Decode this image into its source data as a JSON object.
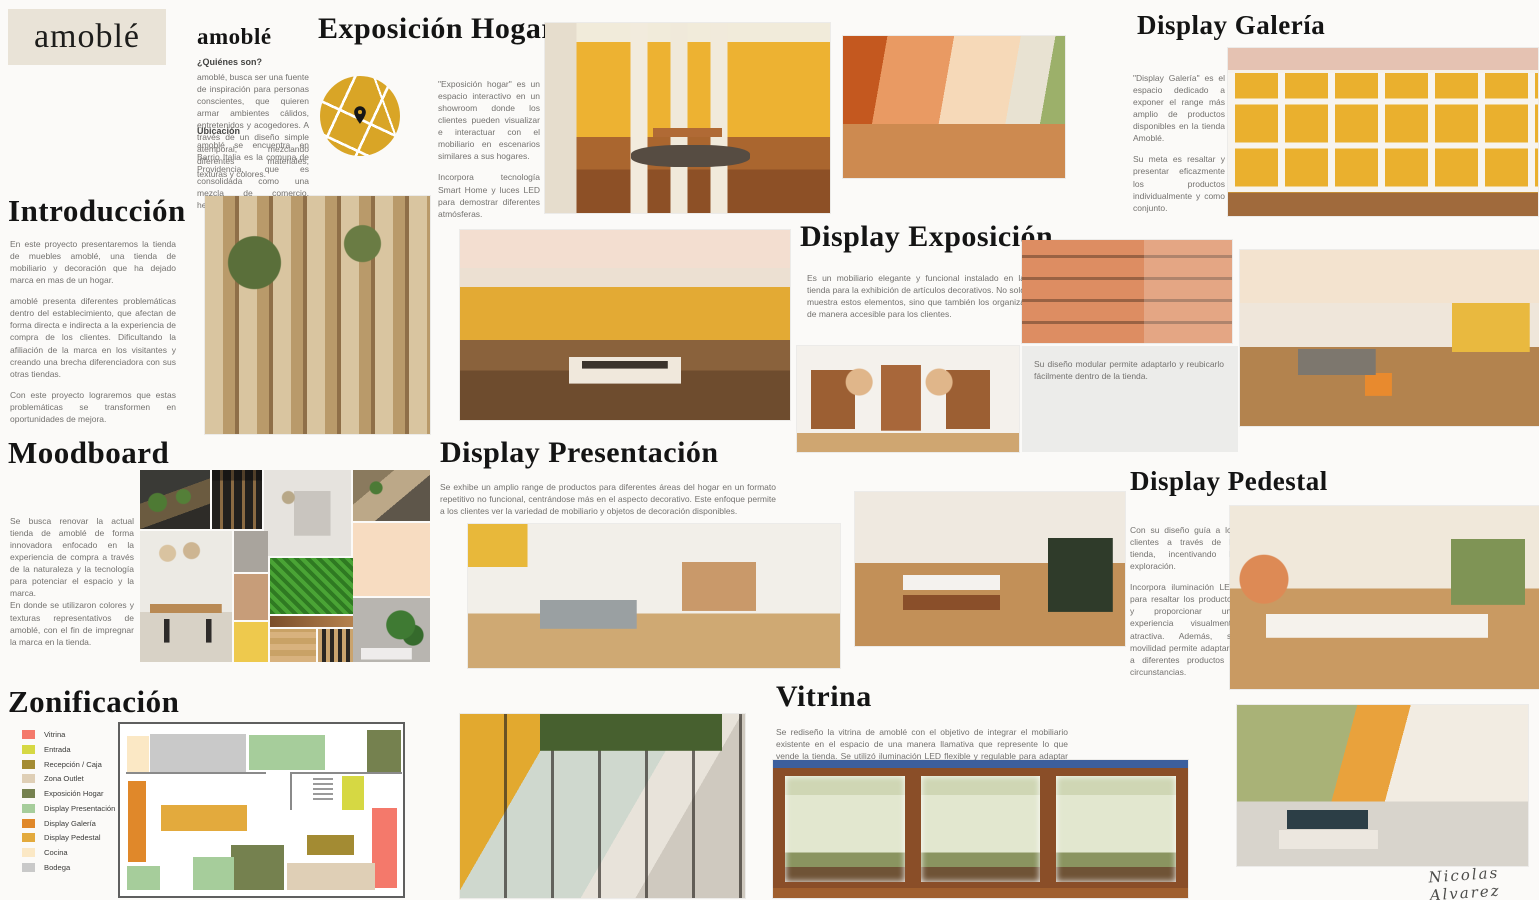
{
  "logo": {
    "text": "amoblé"
  },
  "about": {
    "heading": "amoblé",
    "who_title": "¿Quiénes son?",
    "who_text": "amoblé, busca ser una fuente de inspiración para personas conscientes, que quieren armar ambientes cálidos, entretenidos y acogedores. A través de un diseño simple atemporal, mezclando diferentes materiales, texturas y colores.",
    "location_title": "Ubicación",
    "location_text": "amoblé se encuentra en Barrio Italia es la comuna de Providencia, que es consolidada como una mezcla de comercio, hermosas residencias y cités."
  },
  "exposicion_hogar": {
    "title": "Exposición Hogar",
    "p1": "\"Exposición hogar\" es un espacio interactivo en un showroom donde los clientes pueden visualizar e interactuar con el mobiliario en escenarios similares a sus hogares.",
    "p2": "Incorpora tecnología Smart Home y luces LED para demostrar diferentes atmósferas."
  },
  "introduccion": {
    "title": "Introducción",
    "p1": "En este proyecto presentaremos la tienda de muebles amoblé, una tienda de mobiliario y decoración que ha dejado marca en mas de un hogar.",
    "p2": "amoblé presenta diferentes problemáticas dentro del establecimiento, que afectan de forma directa e indirecta a la experiencia de compra de los clientes. Dificultando la afiliación de la marca en los visitantes y creando una brecha diferenciadora con sus otras tiendas.",
    "p3": "Con este proyecto lograremos que estas problemáticas se transformen en oportunidades de mejora."
  },
  "display_galeria": {
    "title": "Display Galería",
    "p1": "\"Display Galería\" es el espacio dedicado a exponer el range más amplio de productos disponibles en la tienda Amoblé.",
    "p2": "Su meta es resaltar y presentar eficazmente los productos individualmente y como conjunto."
  },
  "display_exposicion": {
    "title": "Display Exposición",
    "text": "Es un mobiliario elegante y funcional instalado en la tienda para la exhibición de artículos decorativos. No solo muestra estos elementos, sino que también los organiza de manera accesible para los clientes.",
    "caption": "Su diseño modular permite adaptarlo y reubicarlo fácilmente dentro de la tienda."
  },
  "moodboard": {
    "title": "Moodboard",
    "p1": "Se busca renovar la actual tienda de amoblé de forma innovadora enfocado en la experiencia de compra a través de la naturaleza y la tecnología para potenciar el espacio y la marca.",
    "p2": "En donde se utilizaron colores y texturas representativos de amoblé, con el fin de impregnar la marca en la tienda."
  },
  "display_presentacion": {
    "title": "Display Presentación",
    "text": "Se exhibe un amplio range de productos para diferentes áreas del hogar en un formato repetitivo no funcional, centrándose más en el aspecto decorativo. Este enfoque permite a los clientes ver la variedad de mobiliario y objetos de decoración disponibles."
  },
  "display_pedestal": {
    "title": "Display Pedestal",
    "p1": "Con su diseño guía a los clientes a través de la tienda, incentivando la exploración.",
    "p2": "Incorpora iluminación LED para resaltar los productos y proporcionar una experiencia visualmente atractiva. Además, su movilidad permite adaptarlo a diferentes productos y circunstancias."
  },
  "zonificacion": {
    "title": "Zonificación",
    "legend": [
      {
        "label": "Vitrina",
        "color": "#f4796b"
      },
      {
        "label": "Entrada",
        "color": "#d6d843"
      },
      {
        "label": "Recepción / Caja",
        "color": "#a38b33"
      },
      {
        "label": "Zona Outlet",
        "color": "#dfcfb6"
      },
      {
        "label": "Exposición Hogar",
        "color": "#75814f"
      },
      {
        "label": "Display Presentación",
        "color": "#a6cd9b"
      },
      {
        "label": "Display Galería",
        "color": "#e0882a"
      },
      {
        "label": "Display Pedestal",
        "color": "#e3aa3d"
      },
      {
        "label": "Cocina",
        "color": "#fbe8c5"
      },
      {
        "label": "Bodega",
        "color": "#c9c9c9"
      }
    ]
  },
  "vitrina": {
    "title": "Vitrina",
    "text": "Se rediseño la vitrina de amoblé con el objetivo de integrar el mobiliario existente en el espacio de una manera llamativa que represente lo que vende la tienda.  Se utilizó iluminación LED flexible y regulable para adaptar la atmósfera del espacio."
  },
  "signature": "Nicolas Alvarez"
}
